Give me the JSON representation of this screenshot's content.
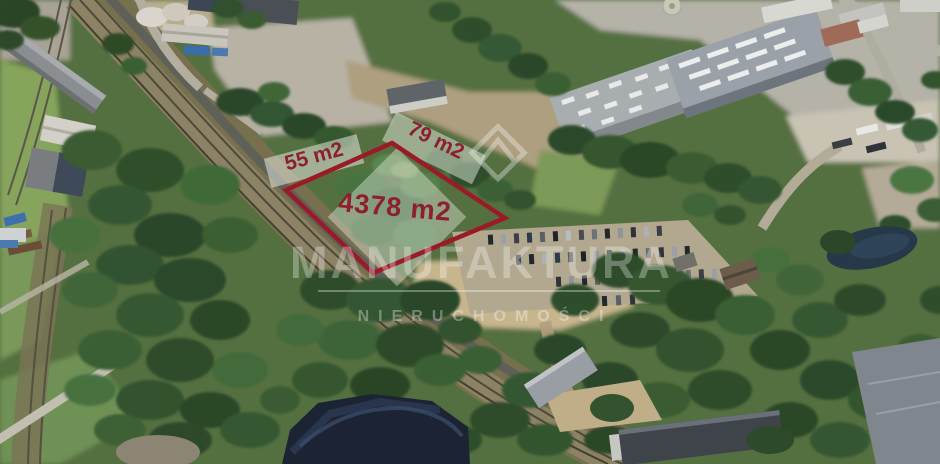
{
  "plot_overlay": {
    "area_label": "4378 m2",
    "west_side_label": "55 m2",
    "north_side_label": "79 m2",
    "outline_color": "#9a1a28",
    "label_color": "#8e1f2e"
  },
  "watermark": {
    "brand": "MANUFAKTURA",
    "subtitle": "NIERUCHOMOŚCI",
    "logo_icon": "diamond-mountain-logo"
  }
}
